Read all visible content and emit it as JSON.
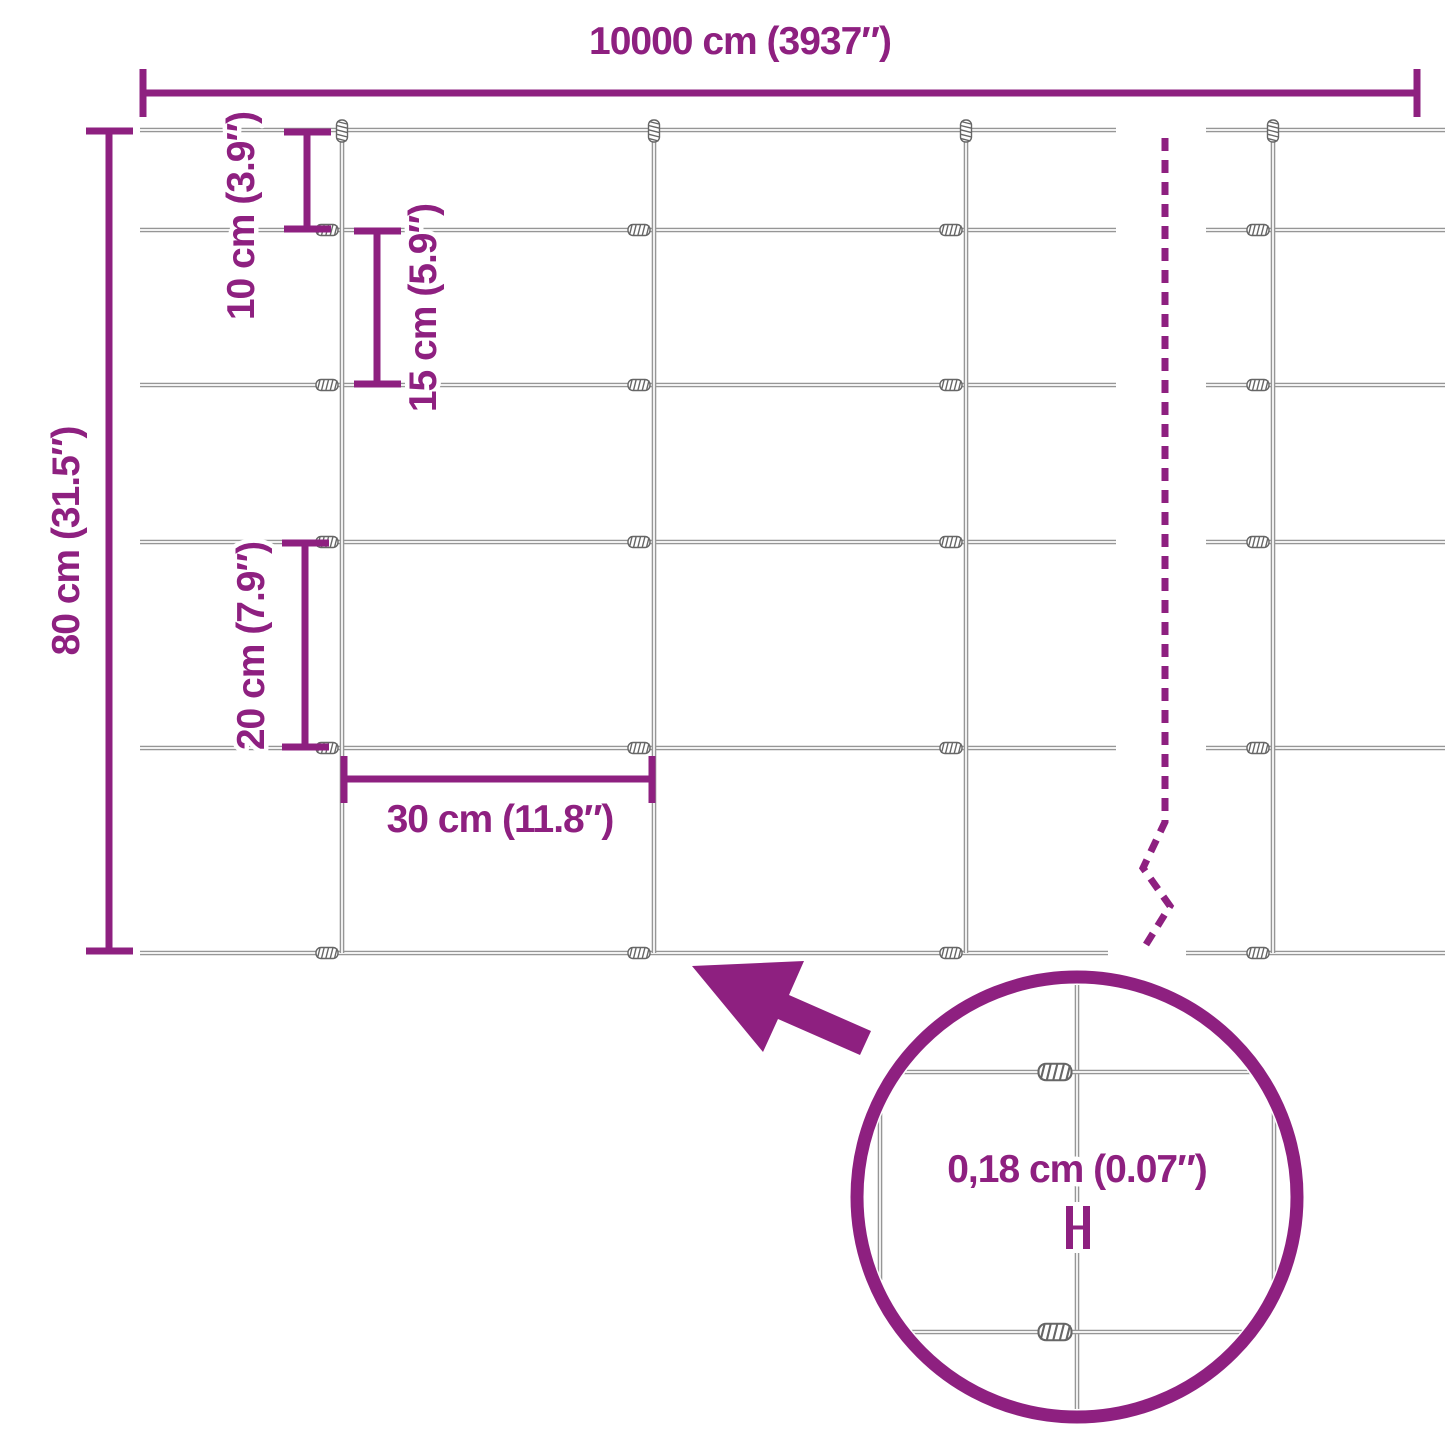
{
  "colors": {
    "accent": "#8E2080",
    "wire": "#969696",
    "coil": "#666666",
    "background": "#FFFFFF"
  },
  "labels": {
    "width": "10000 cm (3937″)",
    "height": "80 cm (31.5″)",
    "row_10": "10 cm (3.9″)",
    "row_15": "15 cm (5.9″)",
    "row_20": "20 cm (7.9″)",
    "col_30": "30 cm (11.8″)",
    "wire_thickness": "0,18 cm (0.07″)"
  }
}
